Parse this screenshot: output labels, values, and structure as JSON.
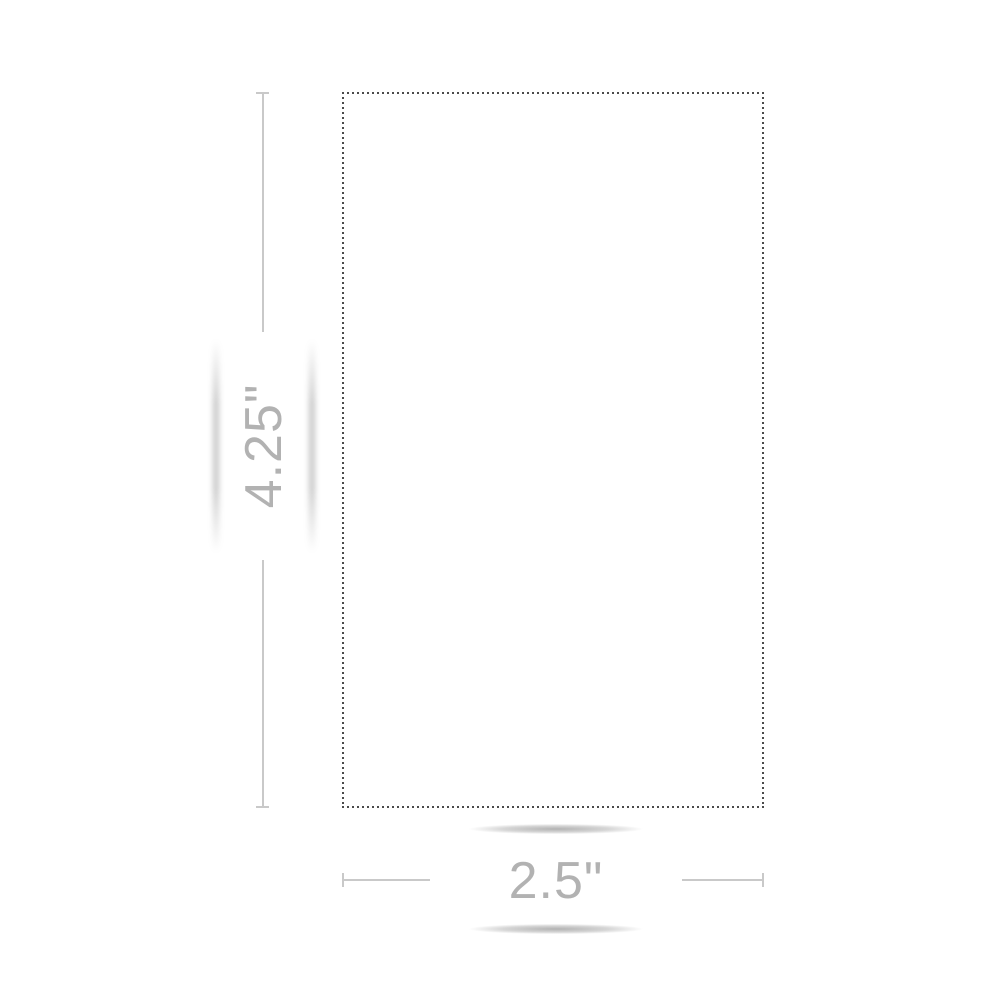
{
  "dimension_preview": {
    "height_label": "4.25\"",
    "width_label": "2.5\"",
    "shape": "rectangle-dashed-cutline",
    "colors": {
      "background": "#ffffff",
      "dashed_border": "#4a4a4a",
      "dimension_line": "#c9c9c9",
      "dimension_text": "#b2b2b2"
    }
  }
}
